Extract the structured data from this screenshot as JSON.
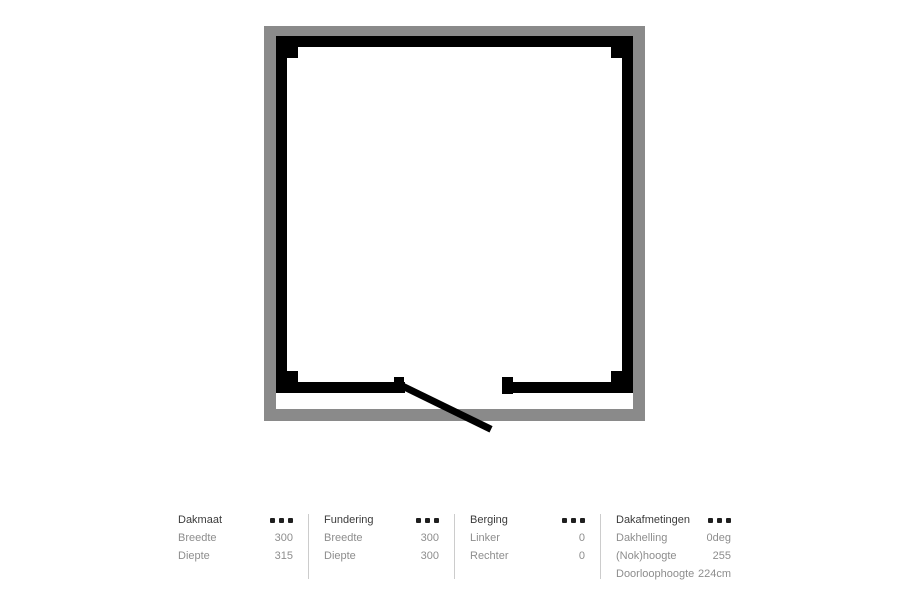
{
  "floorplan": {
    "view": "top-view shed plan",
    "colors": {
      "roof_outline": "#8a8a8a",
      "walls": "#000000",
      "interior": "#ffffff"
    },
    "door": {
      "position": "bottom",
      "state": "open"
    }
  },
  "summary": {
    "colors": {
      "title_text": "#3b3b3b",
      "row_text": "#8d8d8d",
      "divider": "#cccccc",
      "grip_icon": "#1f1f1f"
    },
    "panels": [
      {
        "title": "Dakmaat",
        "rows": [
          {
            "label": "Breedte",
            "value": "300"
          },
          {
            "label": "Diepte",
            "value": "315"
          }
        ]
      },
      {
        "title": "Fundering",
        "rows": [
          {
            "label": "Breedte",
            "value": "300"
          },
          {
            "label": "Diepte",
            "value": "300"
          }
        ]
      },
      {
        "title": "Berging",
        "rows": [
          {
            "label": "Linker",
            "value": "0"
          },
          {
            "label": "Rechter",
            "value": "0"
          }
        ]
      },
      {
        "title": "Dakafmetingen",
        "rows": [
          {
            "label": "Dakhelling",
            "value": "0deg"
          },
          {
            "label": "(Nok)hoogte",
            "value": "255"
          },
          {
            "label": "Doorloophoogte",
            "value": "224cm"
          }
        ]
      }
    ]
  }
}
